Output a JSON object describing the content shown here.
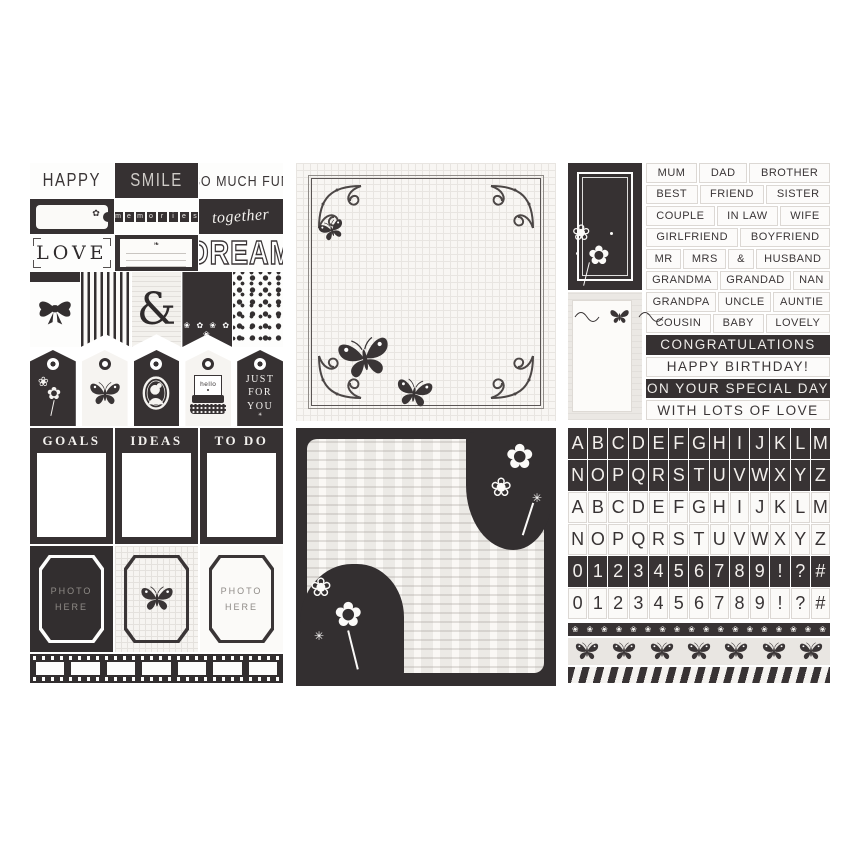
{
  "colors": {
    "ink": "#3a3536",
    "paper": "#ffffff",
    "light_paper": "#ebe8e4",
    "muted_gray": "#8f8b87"
  },
  "icons": {
    "flower": "❀",
    "flower_solid": "✿",
    "sparkle": "✳",
    "sprig": "❧",
    "dot": "•"
  },
  "panel_cards": {
    "happy": "HAPPY",
    "smile": "SMILE",
    "so_much_fun": "SO MUCH FUN",
    "memories_letters": [
      "m",
      "e",
      "m",
      "o",
      "r",
      "i",
      "e",
      "s"
    ],
    "together": "together",
    "love": "LOVE",
    "dream": "DREAM",
    "ampersand": "&",
    "floral_pennant_row": "❀ ✿ ❀ ✿ ❀",
    "tags": [
      {
        "style": "dark",
        "motif": "flower-icon"
      },
      {
        "style": "light",
        "motif": "butterfly-icon"
      },
      {
        "style": "dark",
        "motif": "cameo-icon"
      },
      {
        "style": "light",
        "motif": "typewriter-icon",
        "label": "hello"
      },
      {
        "style": "dark",
        "label": "JUST FOR YOU"
      }
    ]
  },
  "panel_words": {
    "family_rows": [
      [
        "MUM",
        "DAD",
        "BROTHER"
      ],
      [
        "BEST",
        "FRIEND",
        "SISTER"
      ],
      [
        "COUPLE",
        "IN LAW",
        "WIFE"
      ],
      [
        "GIRLFRIEND",
        "BOYFRIEND"
      ],
      [
        "MR",
        "MRS",
        "&",
        "HUSBAND"
      ],
      [
        "GRANDMA",
        "GRANDAD",
        "NAN"
      ],
      [
        "GRANDPA",
        "UNCLE",
        "AUNTIE"
      ],
      [
        "COUSIN",
        "BABY",
        "LOVELY"
      ]
    ],
    "greeting_rows": [
      {
        "text": "CONGRATULATIONS",
        "inverted": true
      },
      {
        "text": "HAPPY BIRTHDAY!",
        "inverted": false
      },
      {
        "text": "ON YOUR SPECIAL DAY",
        "inverted": true
      },
      {
        "text": "WITH LOTS OF LOVE",
        "inverted": false
      }
    ]
  },
  "panel_planner": {
    "list_cards": [
      "GOALS",
      "IDEAS",
      "TO DO"
    ],
    "photo_frames": [
      {
        "bg": "dark",
        "label": "PHOTO HERE"
      },
      {
        "bg": "grid",
        "motif": "butterfly-icon"
      },
      {
        "bg": "light",
        "label": "PHOTO HERE"
      }
    ]
  },
  "panel_alphabet": {
    "tile_rows": [
      {
        "chars": "ABCDEFGHIJKLM",
        "style": "dark"
      },
      {
        "chars": "NOPQRSTUVWXYZ",
        "style": "dark"
      },
      {
        "chars": "ABCDEFGHIJKLM",
        "style": "light"
      },
      {
        "chars": "NOPQRSTUVWXYZ",
        "style": "light"
      },
      {
        "chars": "0123456789!?#",
        "style": "dark"
      },
      {
        "chars": "0123456789!?#",
        "style": "light"
      }
    ]
  }
}
